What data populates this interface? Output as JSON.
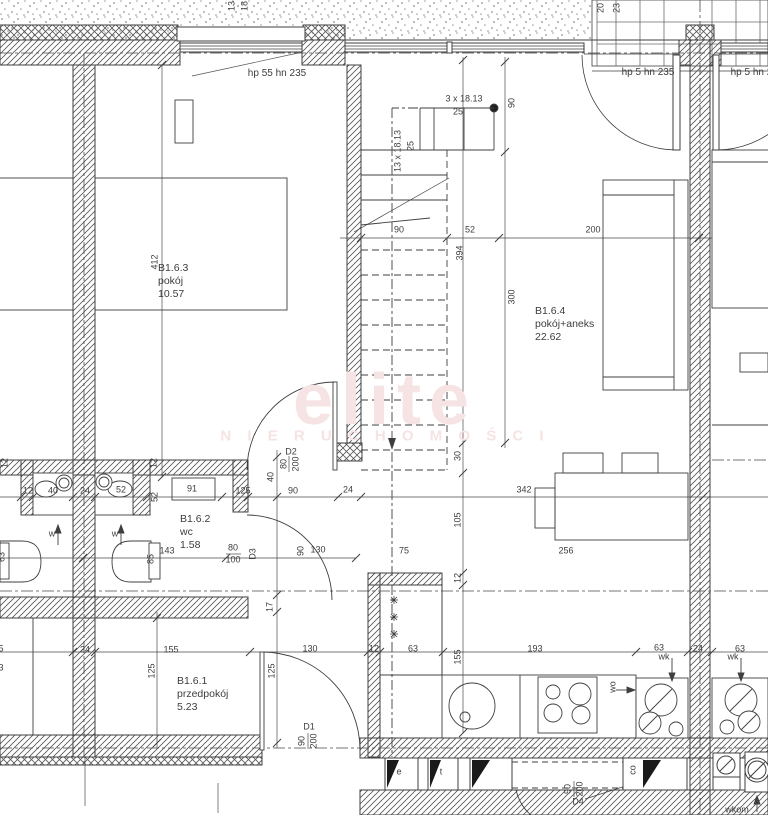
{
  "watermark": {
    "line1": "elite",
    "line2": "N I E R U C H O M O Ś C I",
    "color": "#f6e3e3"
  },
  "rooms": [
    {
      "id": "B1.6.3",
      "name": "pokój",
      "area": "10.57"
    },
    {
      "id": "B1.6.2",
      "name": "wc",
      "area": "1.58"
    },
    {
      "id": "B1.6.1",
      "name": "przedpokój",
      "area": "5.23"
    },
    {
      "id": "B1.6.4",
      "name": "pokój+aneks",
      "area": "22.62"
    }
  ],
  "windows": [
    {
      "label": "hp 55 hn 235"
    },
    {
      "label": "hp 5 hn 235"
    },
    {
      "label": "hp 5 hn 235"
    }
  ],
  "doors": [
    {
      "id": "D1",
      "w": "90",
      "h": "200"
    },
    {
      "id": "D2",
      "w": "80",
      "h": "200"
    },
    {
      "id": "D3",
      "w": "80",
      "h": "100"
    },
    {
      "id": "D4",
      "w": "90",
      "h": "200"
    }
  ],
  "stairs": {
    "flight_top": "3 x 18.13",
    "tread_top": "25",
    "flight_main": "13 x 18.13",
    "tread_main": "25"
  },
  "dims": [
    {
      "t": "13"
    },
    {
      "t": "18"
    },
    {
      "t": "20"
    },
    {
      "t": "23"
    },
    {
      "t": "412"
    },
    {
      "t": "412"
    },
    {
      "t": "90"
    },
    {
      "t": "90"
    },
    {
      "t": "52"
    },
    {
      "t": "200"
    },
    {
      "t": "394"
    },
    {
      "t": "300"
    },
    {
      "t": "30"
    },
    {
      "t": "105"
    },
    {
      "t": "12"
    },
    {
      "t": "155"
    },
    {
      "t": "24"
    },
    {
      "t": "342"
    },
    {
      "t": "12"
    },
    {
      "t": "40"
    },
    {
      "t": "24"
    },
    {
      "t": "52"
    },
    {
      "t": "52"
    },
    {
      "t": "91"
    },
    {
      "t": "125"
    },
    {
      "t": "40"
    },
    {
      "t": "90"
    },
    {
      "t": "63"
    },
    {
      "t": "143"
    },
    {
      "t": "85"
    },
    {
      "t": "90"
    },
    {
      "t": "130"
    },
    {
      "t": "17"
    },
    {
      "t": "5"
    },
    {
      "t": "3"
    },
    {
      "t": "24"
    },
    {
      "t": "155"
    },
    {
      "t": "125"
    },
    {
      "t": "125"
    },
    {
      "t": "130"
    },
    {
      "t": "12"
    },
    {
      "t": "63"
    },
    {
      "t": "193"
    },
    {
      "t": "63"
    },
    {
      "t": "24"
    },
    {
      "t": "63"
    },
    {
      "t": "75"
    },
    {
      "t": "256"
    },
    {
      "t": "12"
    },
    {
      "t": "12"
    }
  ],
  "annotations": [
    {
      "t": "w"
    },
    {
      "t": "w"
    },
    {
      "t": "wk"
    },
    {
      "t": "wk"
    },
    {
      "t": "wo"
    },
    {
      "t": "co"
    },
    {
      "t": "e"
    },
    {
      "t": "t"
    },
    {
      "t": "wkom"
    }
  ]
}
